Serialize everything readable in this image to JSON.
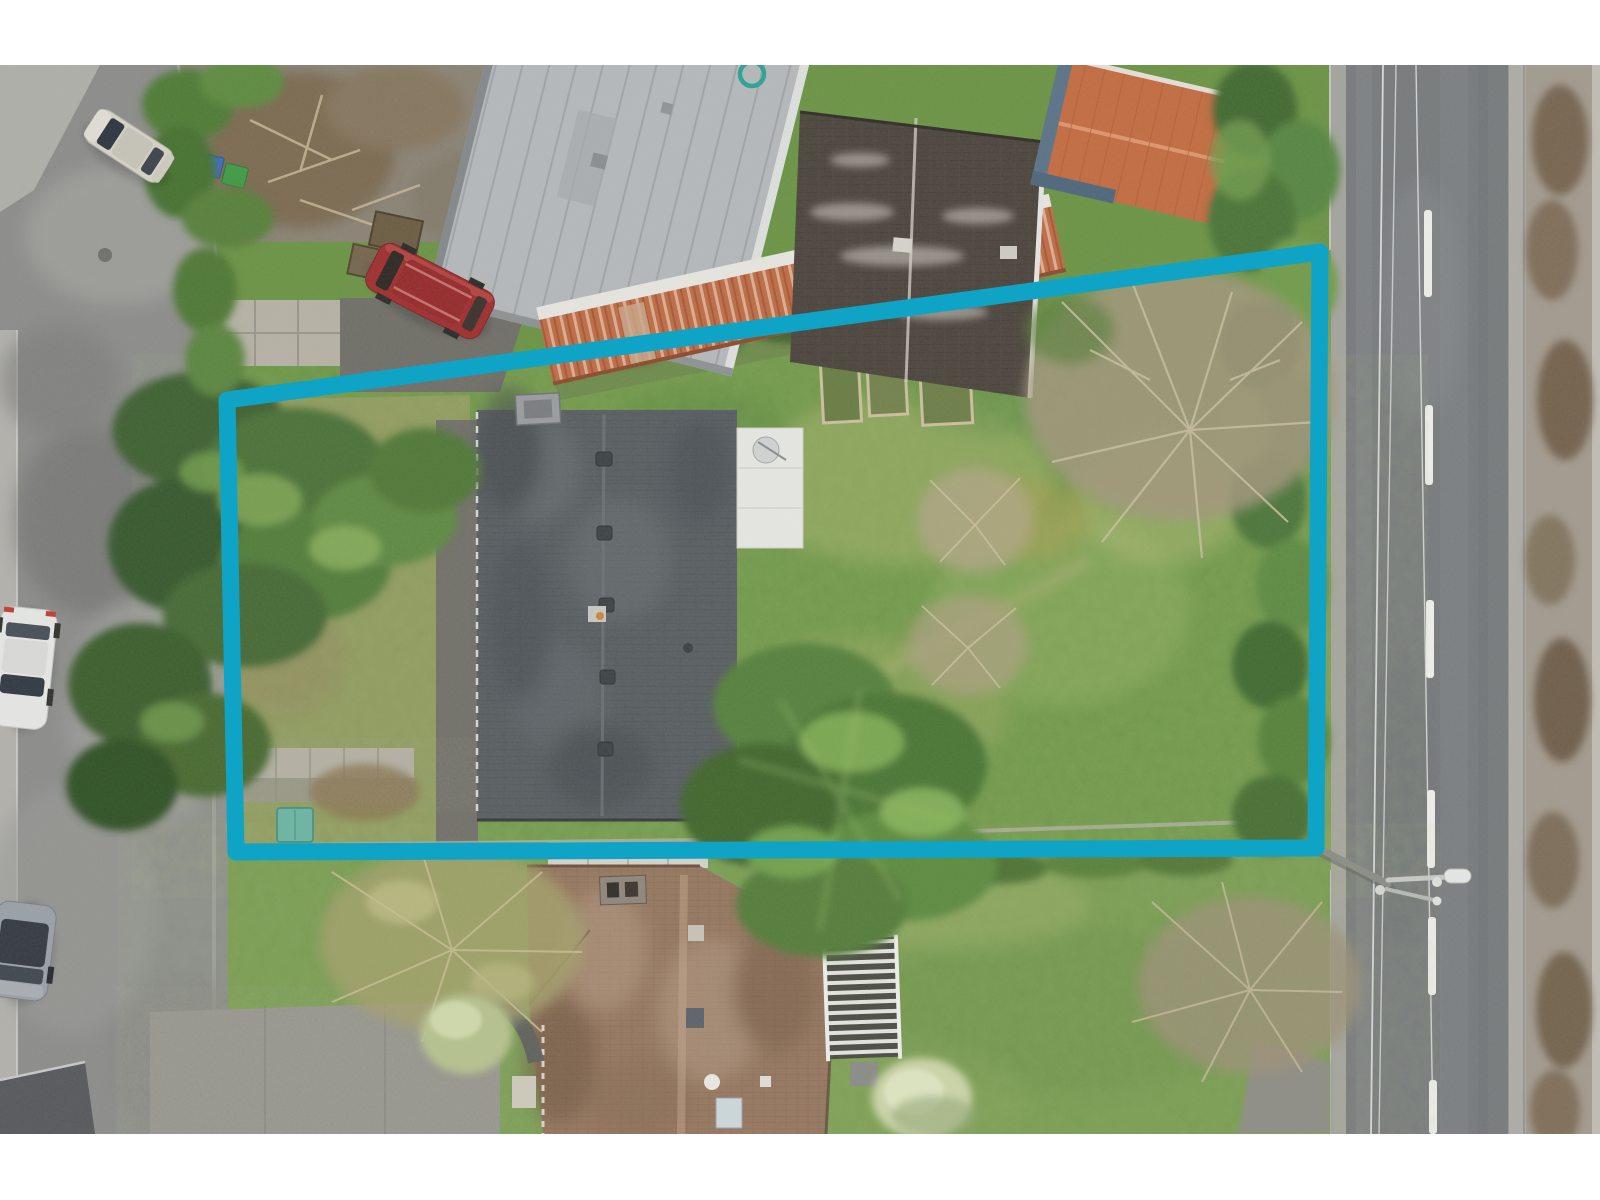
{
  "meta": {
    "kind": "aerial-drone-photograph",
    "subject": "residential parcel with highlighted property boundary",
    "view": "top-down nadir"
  },
  "frame": {
    "width": 1600,
    "height": 1200,
    "photo_top": 65,
    "photo_bottom": 1134,
    "letterbox_color": "#ffffff"
  },
  "annotation": {
    "boundary": {
      "shape": "quadrilateral",
      "points": "227,400 1320,252 1316,848 236,852",
      "color": "#0fa4c6",
      "stroke_width": 17
    }
  },
  "palette": {
    "boundary_teal": "#0fa4c6",
    "street_gray": "#8c8c89",
    "highway_asphalt": "#77797b",
    "lawn_green": "#6a9342",
    "bright_lawn": "#7aa04c",
    "conifer_dark": "#3d5f2d",
    "conifer_light": "#7fa653",
    "main_roof_gray": "#585c60",
    "metal_roof_gray": "#b6b9bb",
    "terracotta_band": "#c06a42",
    "dark_brown_roof": "#4a423a",
    "orange_shed_roof": "#c46a3e",
    "clay_tile_roof": "#96765d",
    "bare_tree_tan": "#a89a78",
    "gravel_verge": "#a39a8d",
    "driveway_pale": "#97958c"
  },
  "objects": {
    "cars": [
      {
        "id": "beige-sedan",
        "color": "#d7d3c7",
        "location": "street upper-left"
      },
      {
        "id": "white-hatchback",
        "color": "#e8e8e6",
        "location": "street mid-left"
      },
      {
        "id": "gray-car",
        "color": "#9aa0a6",
        "location": "street lower-left"
      },
      {
        "id": "red-minivan",
        "color": "#a02a2b",
        "location": "gravel driveway top"
      }
    ],
    "buildings": [
      {
        "id": "metal-roof-house",
        "roof_color": "#b6b9bb",
        "location": "top-center"
      },
      {
        "id": "terracotta-roof-band",
        "roof_color": "#c06a42",
        "location": "top-center lower edge"
      },
      {
        "id": "dark-brown-roof-house",
        "roof_color": "#4a423a",
        "location": "top-right of parcel"
      },
      {
        "id": "orange-garden-shed",
        "roof_color": "#c46a3e",
        "location": "top-right"
      },
      {
        "id": "main-house",
        "roof_color": "#585c60",
        "location": "inside parcel"
      },
      {
        "id": "clay-tile-house",
        "roof_color": "#96765d",
        "location": "below parcel"
      }
    ],
    "site_features": [
      {
        "id": "street-lamp",
        "location": "right highway edge"
      },
      {
        "id": "green-utility-box",
        "color": "#6cb4a2"
      },
      {
        "id": "recycling-bins",
        "colors": [
          "#3a6bc0",
          "#3f9a44"
        ]
      },
      {
        "id": "raised-garden-beds",
        "count": 3
      },
      {
        "id": "white-pergola"
      },
      {
        "id": "lane-dashes",
        "color": "#f0f0ec"
      }
    ]
  }
}
